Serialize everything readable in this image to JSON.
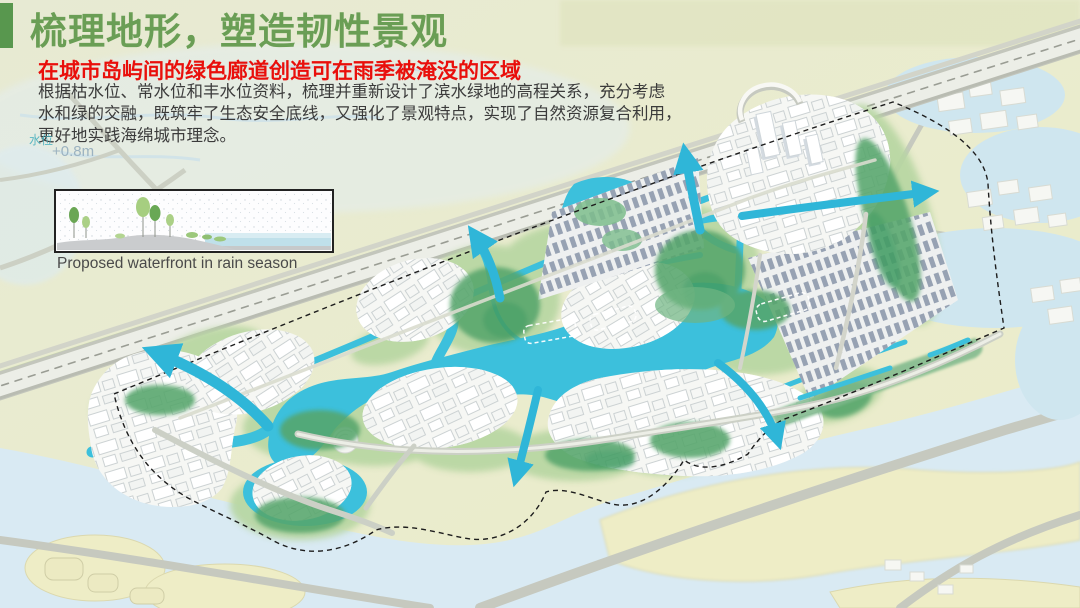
{
  "slide": {
    "accent_bar_color": "#58974e",
    "title": "梳理地形，塑造韧性景观",
    "title_color": "#6a9e55",
    "subtitle": "在城市岛屿间的绿色廊道创造可在雨季被淹没的区域",
    "subtitle_color": "#e90f0b",
    "body_lines": [
      "根据枯水位、常水位和丰水位资料，梳理并重新设计了滨水绿地的高程关系，充分考虑",
      "水和绿的交融，既筑牢了生态安全底线，又强化了景观特点，实现了自然资源复合利用，",
      "更好地实践海绵城市理念。"
    ],
    "body_color": "#3b3b3b"
  },
  "inset": {
    "caption": "Proposed waterfront in rain season"
  },
  "map": {
    "labels": {
      "water_level": "水位",
      "elevation": "+0.8m"
    },
    "colors": {
      "land": "#e9ebce",
      "field": "#eeedc6",
      "outer_water": "#d9eaf3",
      "pond": "#cfe6ef",
      "canal": "#3cc0dc",
      "arrow": "#2fb6d8",
      "greenery_dark": "#55a36b",
      "greenery_light": "#b7d6a2",
      "building": "#ffffff",
      "building_roof": "#98a3b3",
      "road": "#cdd0c5",
      "highway": "#e9eae2",
      "boundary": "#1d1d1d"
    }
  }
}
